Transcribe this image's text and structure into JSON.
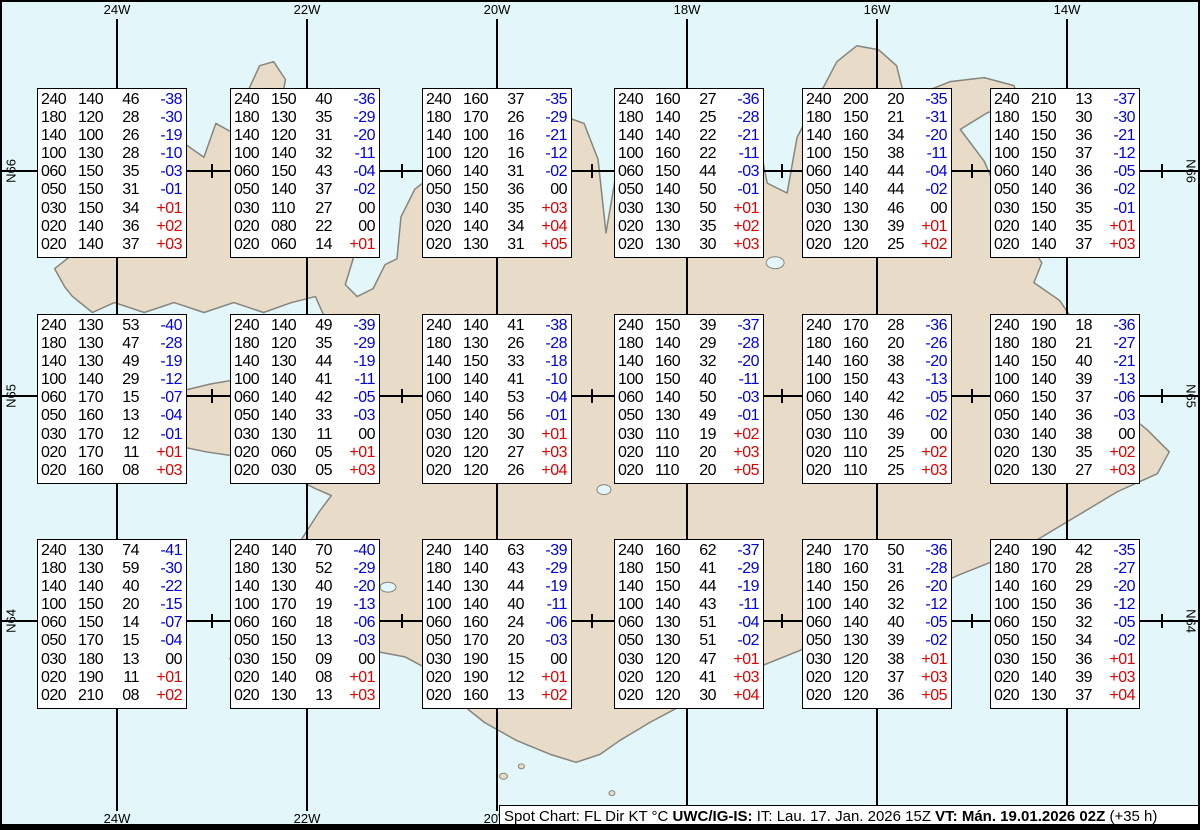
{
  "title": "Spot Chart: FL Dir KT °C UWC/IG-IS: IT: Lau. 17. Jan. 2026 15Z VT: Mán. 19.01.2026 02Z (+35 h)",
  "colors": {
    "ocean": "#e3f6fa",
    "land": "#e8dcc8",
    "coast": "#85857d",
    "grid-line": "#000000",
    "box-bg": "#ffffff",
    "box-border": "#000000",
    "temp-neg": "#0000dd",
    "temp-pos": "#e00000"
  },
  "grid": {
    "meridians": [
      {
        "label": "24W",
        "x": 115
      },
      {
        "label": "22W",
        "x": 305
      },
      {
        "label": "20W",
        "x": 495
      },
      {
        "label": "18W",
        "x": 685
      },
      {
        "label": "16W",
        "x": 875
      },
      {
        "label": "14W",
        "x": 1065
      }
    ],
    "parallels": [
      {
        "label": "N66",
        "y": 169
      },
      {
        "label": "N65",
        "y": 394
      },
      {
        "label": "N64",
        "y": 619
      }
    ],
    "minor_tick_xs": [
      210,
      400,
      590,
      780,
      970,
      1160
    ]
  },
  "chart_data": {
    "type": "table",
    "columns": [
      "FL",
      "Dir",
      "KT",
      "°C"
    ],
    "station_grid": {
      "cols_x": [
        35,
        228,
        420,
        612,
        800,
        988
      ],
      "rows_y": [
        86,
        312,
        537
      ],
      "box_w": 150,
      "box_h": 170
    },
    "stations": [
      {
        "row": 0,
        "col": 0,
        "rows": [
          [
            "240",
            "140",
            "46",
            "-38"
          ],
          [
            "180",
            "120",
            "28",
            "-30"
          ],
          [
            "140",
            "100",
            "26",
            "-19"
          ],
          [
            "100",
            "130",
            "28",
            "-10"
          ],
          [
            "060",
            "150",
            "35",
            "-03"
          ],
          [
            "050",
            "150",
            "31",
            "-01"
          ],
          [
            "030",
            "150",
            "34",
            "+01"
          ],
          [
            "020",
            "140",
            "36",
            "+02"
          ],
          [
            "020",
            "140",
            "37",
            "+03"
          ]
        ]
      },
      {
        "row": 0,
        "col": 1,
        "rows": [
          [
            "240",
            "150",
            "40",
            "-36"
          ],
          [
            "180",
            "130",
            "35",
            "-29"
          ],
          [
            "140",
            "120",
            "31",
            "-20"
          ],
          [
            "100",
            "140",
            "32",
            "-11"
          ],
          [
            "060",
            "150",
            "43",
            "-04"
          ],
          [
            "050",
            "140",
            "37",
            "-02"
          ],
          [
            "030",
            "110",
            "27",
            "00"
          ],
          [
            "020",
            "080",
            "22",
            "00"
          ],
          [
            "020",
            "060",
            "14",
            "+01"
          ]
        ]
      },
      {
        "row": 0,
        "col": 2,
        "rows": [
          [
            "240",
            "160",
            "37",
            "-35"
          ],
          [
            "180",
            "170",
            "26",
            "-29"
          ],
          [
            "140",
            "100",
            "16",
            "-21"
          ],
          [
            "100",
            "120",
            "16",
            "-12"
          ],
          [
            "060",
            "140",
            "31",
            "-02"
          ],
          [
            "050",
            "150",
            "36",
            "00"
          ],
          [
            "030",
            "140",
            "35",
            "+03"
          ],
          [
            "020",
            "140",
            "34",
            "+04"
          ],
          [
            "020",
            "130",
            "31",
            "+05"
          ]
        ]
      },
      {
        "row": 0,
        "col": 3,
        "rows": [
          [
            "240",
            "160",
            "27",
            "-36"
          ],
          [
            "180",
            "140",
            "25",
            "-28"
          ],
          [
            "140",
            "140",
            "22",
            "-21"
          ],
          [
            "100",
            "160",
            "22",
            "-11"
          ],
          [
            "060",
            "150",
            "44",
            "-03"
          ],
          [
            "050",
            "140",
            "50",
            "-01"
          ],
          [
            "030",
            "130",
            "50",
            "+01"
          ],
          [
            "020",
            "130",
            "35",
            "+02"
          ],
          [
            "020",
            "130",
            "30",
            "+03"
          ]
        ]
      },
      {
        "row": 0,
        "col": 4,
        "rows": [
          [
            "240",
            "200",
            "20",
            "-35"
          ],
          [
            "180",
            "150",
            "21",
            "-31"
          ],
          [
            "140",
            "160",
            "34",
            "-20"
          ],
          [
            "100",
            "150",
            "38",
            "-11"
          ],
          [
            "060",
            "140",
            "44",
            "-04"
          ],
          [
            "050",
            "140",
            "44",
            "-02"
          ],
          [
            "030",
            "130",
            "46",
            "00"
          ],
          [
            "020",
            "130",
            "39",
            "+01"
          ],
          [
            "020",
            "120",
            "25",
            "+02"
          ]
        ]
      },
      {
        "row": 0,
        "col": 5,
        "rows": [
          [
            "240",
            "210",
            "13",
            "-37"
          ],
          [
            "180",
            "150",
            "30",
            "-30"
          ],
          [
            "140",
            "150",
            "36",
            "-21"
          ],
          [
            "100",
            "150",
            "37",
            "-12"
          ],
          [
            "060",
            "140",
            "36",
            "-05"
          ],
          [
            "050",
            "140",
            "36",
            "-02"
          ],
          [
            "030",
            "150",
            "35",
            "-01"
          ],
          [
            "020",
            "140",
            "35",
            "+01"
          ],
          [
            "020",
            "140",
            "37",
            "+03"
          ]
        ]
      },
      {
        "row": 1,
        "col": 0,
        "rows": [
          [
            "240",
            "130",
            "53",
            "-40"
          ],
          [
            "180",
            "130",
            "47",
            "-28"
          ],
          [
            "140",
            "130",
            "49",
            "-19"
          ],
          [
            "100",
            "140",
            "29",
            "-12"
          ],
          [
            "060",
            "170",
            "15",
            "-07"
          ],
          [
            "050",
            "160",
            "13",
            "-04"
          ],
          [
            "030",
            "170",
            "12",
            "-01"
          ],
          [
            "020",
            "170",
            "11",
            "+01"
          ],
          [
            "020",
            "160",
            "08",
            "+03"
          ]
        ]
      },
      {
        "row": 1,
        "col": 1,
        "rows": [
          [
            "240",
            "140",
            "49",
            "-39"
          ],
          [
            "180",
            "120",
            "35",
            "-29"
          ],
          [
            "140",
            "130",
            "44",
            "-19"
          ],
          [
            "100",
            "140",
            "41",
            "-11"
          ],
          [
            "060",
            "140",
            "42",
            "-05"
          ],
          [
            "050",
            "140",
            "33",
            "-03"
          ],
          [
            "030",
            "130",
            "11",
            "00"
          ],
          [
            "020",
            "060",
            "05",
            "+01"
          ],
          [
            "020",
            "030",
            "05",
            "+03"
          ]
        ]
      },
      {
        "row": 1,
        "col": 2,
        "rows": [
          [
            "240",
            "140",
            "41",
            "-38"
          ],
          [
            "180",
            "130",
            "26",
            "-28"
          ],
          [
            "140",
            "150",
            "33",
            "-18"
          ],
          [
            "100",
            "140",
            "41",
            "-10"
          ],
          [
            "060",
            "140",
            "53",
            "-04"
          ],
          [
            "050",
            "140",
            "56",
            "-01"
          ],
          [
            "030",
            "120",
            "30",
            "+01"
          ],
          [
            "020",
            "120",
            "27",
            "+03"
          ],
          [
            "020",
            "120",
            "26",
            "+04"
          ]
        ]
      },
      {
        "row": 1,
        "col": 3,
        "rows": [
          [
            "240",
            "150",
            "39",
            "-37"
          ],
          [
            "180",
            "140",
            "29",
            "-28"
          ],
          [
            "140",
            "160",
            "32",
            "-20"
          ],
          [
            "100",
            "150",
            "40",
            "-11"
          ],
          [
            "060",
            "140",
            "50",
            "-03"
          ],
          [
            "050",
            "130",
            "49",
            "-01"
          ],
          [
            "030",
            "110",
            "19",
            "+02"
          ],
          [
            "020",
            "110",
            "20",
            "+03"
          ],
          [
            "020",
            "110",
            "20",
            "+05"
          ]
        ]
      },
      {
        "row": 1,
        "col": 4,
        "rows": [
          [
            "240",
            "170",
            "28",
            "-36"
          ],
          [
            "180",
            "160",
            "20",
            "-26"
          ],
          [
            "140",
            "160",
            "38",
            "-20"
          ],
          [
            "100",
            "150",
            "43",
            "-13"
          ],
          [
            "060",
            "140",
            "42",
            "-05"
          ],
          [
            "050",
            "130",
            "46",
            "-02"
          ],
          [
            "030",
            "110",
            "39",
            "00"
          ],
          [
            "020",
            "110",
            "25",
            "+02"
          ],
          [
            "020",
            "110",
            "25",
            "+03"
          ]
        ]
      },
      {
        "row": 1,
        "col": 5,
        "rows": [
          [
            "240",
            "190",
            "18",
            "-36"
          ],
          [
            "180",
            "180",
            "21",
            "-27"
          ],
          [
            "140",
            "150",
            "40",
            "-21"
          ],
          [
            "100",
            "140",
            "39",
            "-13"
          ],
          [
            "060",
            "150",
            "37",
            "-06"
          ],
          [
            "050",
            "140",
            "36",
            "-03"
          ],
          [
            "030",
            "140",
            "38",
            "00"
          ],
          [
            "020",
            "130",
            "35",
            "+02"
          ],
          [
            "020",
            "130",
            "27",
            "+03"
          ]
        ]
      },
      {
        "row": 2,
        "col": 0,
        "rows": [
          [
            "240",
            "130",
            "74",
            "-41"
          ],
          [
            "180",
            "130",
            "59",
            "-30"
          ],
          [
            "140",
            "140",
            "40",
            "-22"
          ],
          [
            "100",
            "150",
            "20",
            "-15"
          ],
          [
            "060",
            "150",
            "14",
            "-07"
          ],
          [
            "050",
            "170",
            "15",
            "-04"
          ],
          [
            "030",
            "180",
            "13",
            "00"
          ],
          [
            "020",
            "190",
            "11",
            "+01"
          ],
          [
            "020",
            "210",
            "08",
            "+02"
          ]
        ]
      },
      {
        "row": 2,
        "col": 1,
        "rows": [
          [
            "240",
            "140",
            "70",
            "-40"
          ],
          [
            "180",
            "130",
            "52",
            "-29"
          ],
          [
            "140",
            "130",
            "40",
            "-20"
          ],
          [
            "100",
            "170",
            "19",
            "-13"
          ],
          [
            "060",
            "160",
            "18",
            "-06"
          ],
          [
            "050",
            "150",
            "13",
            "-03"
          ],
          [
            "030",
            "150",
            "09",
            "00"
          ],
          [
            "020",
            "140",
            "08",
            "+01"
          ],
          [
            "020",
            "130",
            "13",
            "+03"
          ]
        ]
      },
      {
        "row": 2,
        "col": 2,
        "rows": [
          [
            "240",
            "140",
            "63",
            "-39"
          ],
          [
            "180",
            "140",
            "43",
            "-29"
          ],
          [
            "140",
            "130",
            "44",
            "-19"
          ],
          [
            "100",
            "140",
            "40",
            "-11"
          ],
          [
            "060",
            "160",
            "24",
            "-06"
          ],
          [
            "050",
            "170",
            "20",
            "-03"
          ],
          [
            "030",
            "190",
            "15",
            "00"
          ],
          [
            "020",
            "190",
            "12",
            "+01"
          ],
          [
            "020",
            "160",
            "13",
            "+02"
          ]
        ]
      },
      {
        "row": 2,
        "col": 3,
        "rows": [
          [
            "240",
            "160",
            "62",
            "-37"
          ],
          [
            "180",
            "150",
            "41",
            "-29"
          ],
          [
            "140",
            "150",
            "44",
            "-19"
          ],
          [
            "100",
            "140",
            "43",
            "-11"
          ],
          [
            "060",
            "130",
            "51",
            "-04"
          ],
          [
            "050",
            "130",
            "51",
            "-02"
          ],
          [
            "030",
            "120",
            "47",
            "+01"
          ],
          [
            "020",
            "120",
            "41",
            "+03"
          ],
          [
            "020",
            "120",
            "30",
            "+04"
          ]
        ]
      },
      {
        "row": 2,
        "col": 4,
        "rows": [
          [
            "240",
            "170",
            "50",
            "-36"
          ],
          [
            "180",
            "160",
            "31",
            "-28"
          ],
          [
            "140",
            "150",
            "26",
            "-20"
          ],
          [
            "100",
            "140",
            "32",
            "-12"
          ],
          [
            "060",
            "140",
            "40",
            "-05"
          ],
          [
            "050",
            "130",
            "39",
            "-02"
          ],
          [
            "030",
            "120",
            "38",
            "+01"
          ],
          [
            "020",
            "120",
            "37",
            "+03"
          ],
          [
            "020",
            "120",
            "36",
            "+05"
          ]
        ]
      },
      {
        "row": 2,
        "col": 5,
        "rows": [
          [
            "240",
            "190",
            "42",
            "-35"
          ],
          [
            "180",
            "170",
            "28",
            "-27"
          ],
          [
            "140",
            "160",
            "29",
            "-20"
          ],
          [
            "100",
            "150",
            "36",
            "-12"
          ],
          [
            "060",
            "150",
            "32",
            "-05"
          ],
          [
            "050",
            "150",
            "34",
            "-02"
          ],
          [
            "030",
            "150",
            "36",
            "+01"
          ],
          [
            "020",
            "140",
            "39",
            "+03"
          ],
          [
            "020",
            "130",
            "37",
            "+04"
          ]
        ]
      }
    ]
  },
  "footer": {
    "segments": [
      {
        "text": "Spot Chart: FL Dir KT °C ",
        "bold": false
      },
      {
        "text": "UWC/IG-IS:",
        "bold": true
      },
      {
        "text": " IT: Lau. 17. Jan. 2026 15Z ",
        "bold": false
      },
      {
        "text": "VT: ",
        "bold": true
      },
      {
        "text": "Mán. 19.01.2026 02Z",
        "bold": true
      },
      {
        "text": " (+35 h)",
        "bold": false
      }
    ]
  }
}
